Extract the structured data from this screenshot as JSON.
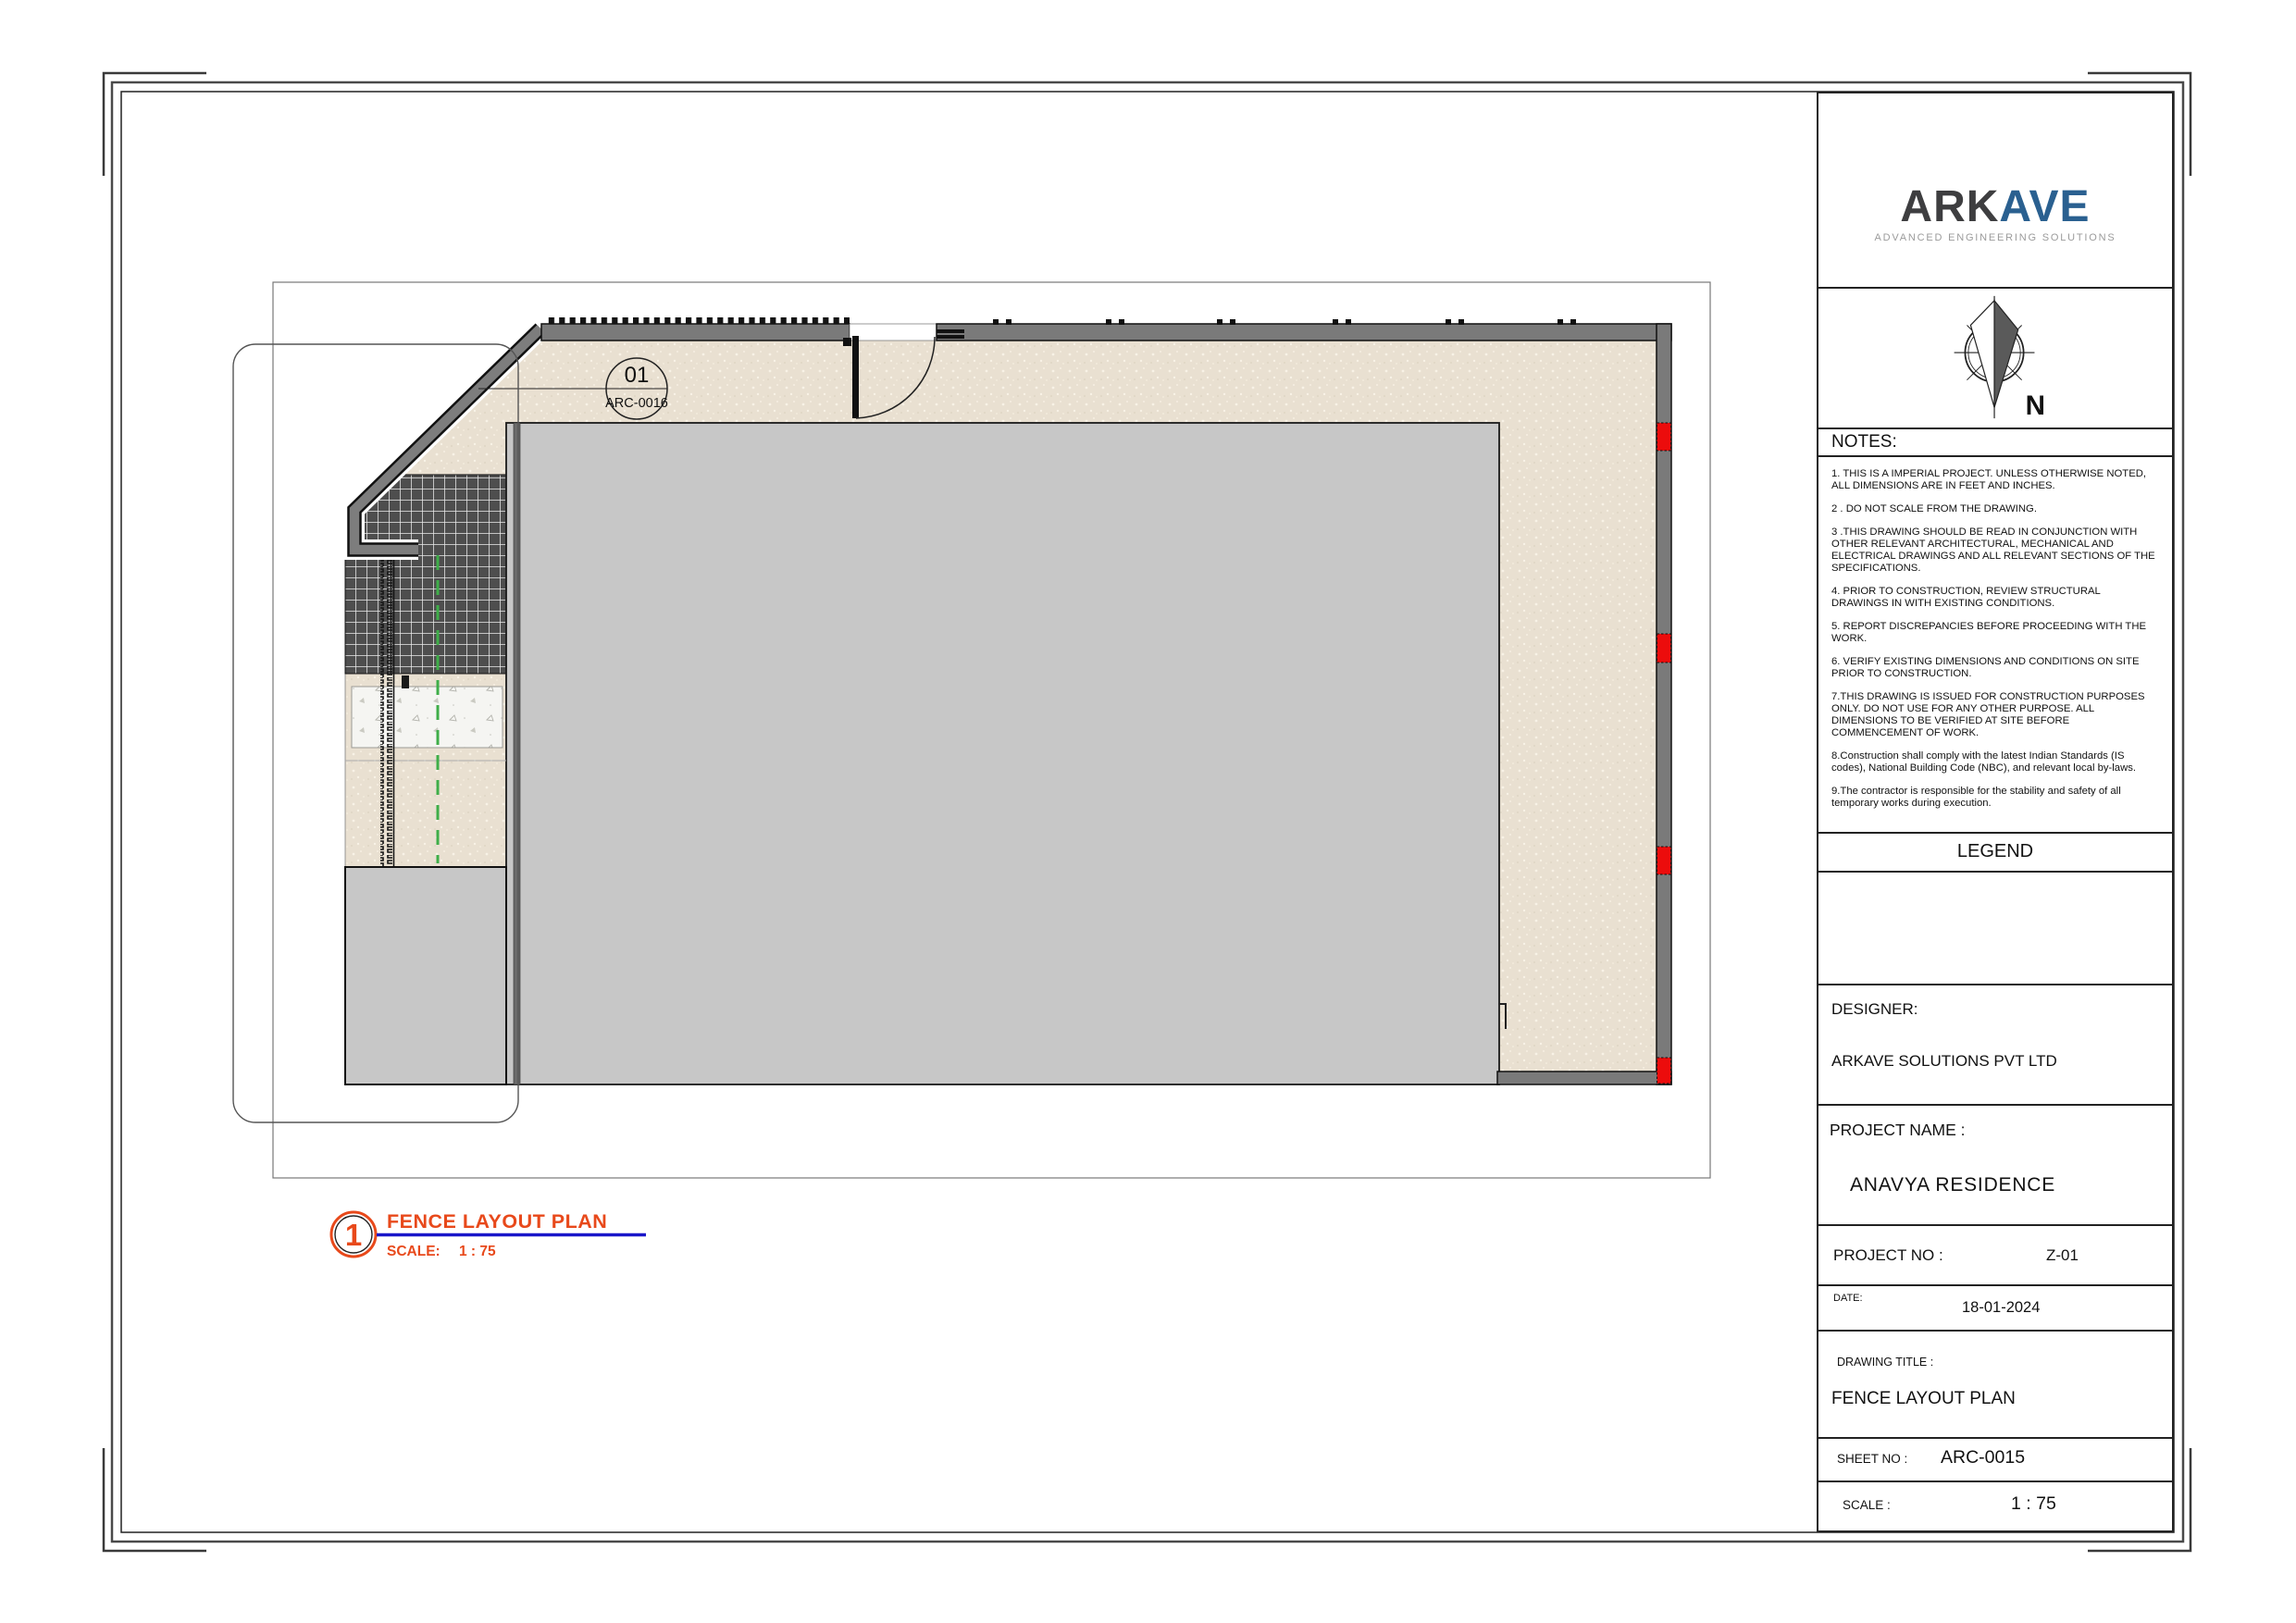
{
  "colors": {
    "accent_orange": "#e8491b",
    "underline_blue": "#1a17c9",
    "logo_dark": "#3e3e40",
    "logo_blue": "#2a6090",
    "wall_gray": "#7a7a7a",
    "building_gray": "#c7c7c7",
    "ground_beige": "#e9e0d1",
    "marker_red": "#ec0c0c",
    "centerline_green": "#3fae49"
  },
  "logo": {
    "brand_prefix": "ARK",
    "brand_suffix": "AVE",
    "tagline": "ADVANCED ENGINEERING SOLUTIONS"
  },
  "compass": {
    "north_label": "N"
  },
  "titleblock": {
    "notes_header": "NOTES:",
    "notes": [
      "1. THIS IS A IMPERIAL PROJECT. UNLESS OTHERWISE NOTED, ALL DIMENSIONS ARE IN FEET AND INCHES.",
      "2 . DO NOT SCALE FROM THE DRAWING.",
      "3 .THIS DRAWING SHOULD BE READ IN CONJUNCTION WITH OTHER RELEVANT ARCHITECTURAL, MECHANICAL AND ELECTRICAL DRAWINGS AND ALL RELEVANT SECTIONS OF THE SPECIFICATIONS.",
      "4. PRIOR TO CONSTRUCTION, REVIEW STRUCTURAL DRAWINGS IN  WITH EXISTING CONDITIONS.",
      "5. REPORT DISCREPANCIES BEFORE PROCEEDING WITH THE WORK.",
      "6. VERIFY EXISTING DIMENSIONS AND CONDITIONS ON SITE PRIOR TO CONSTRUCTION.",
      "7.THIS DRAWING IS ISSUED FOR CONSTRUCTION PURPOSES ONLY. DO NOT USE FOR ANY OTHER PURPOSE. ALL DIMENSIONS TO BE VERIFIED AT SITE BEFORE COMMENCEMENT OF WORK.",
      "8.Construction shall comply with the latest Indian Standards (IS codes), National Building Code (NBC), and relevant local by-laws.",
      "9.The contractor is responsible for the stability and safety of all temporary works during execution."
    ],
    "legend_header": "LEGEND",
    "designer_label": "DESIGNER:",
    "designer_value": "ARKAVE SOLUTIONS PVT LTD",
    "project_name_label": "PROJECT NAME :",
    "project_name_value": "ANAVYA RESIDENCE",
    "project_no_label": "PROJECT NO :",
    "project_no_value": "Z-01",
    "date_label": "DATE:",
    "date_value": "18-01-2024",
    "drawing_title_label": "DRAWING TITLE :",
    "drawing_title_value": "FENCE LAYOUT PLAN",
    "sheet_no_label": "SHEET NO :",
    "sheet_no_value": "ARC-0015",
    "scale_label": "SCALE :",
    "scale_value": "1 : 75"
  },
  "plan": {
    "callout": {
      "number": "01",
      "sheet_ref": "ARC-0016"
    },
    "view_title": {
      "number": "1",
      "title": "FENCE LAYOUT PLAN",
      "scale_label": "SCALE:",
      "scale_value": "1 : 75"
    }
  }
}
